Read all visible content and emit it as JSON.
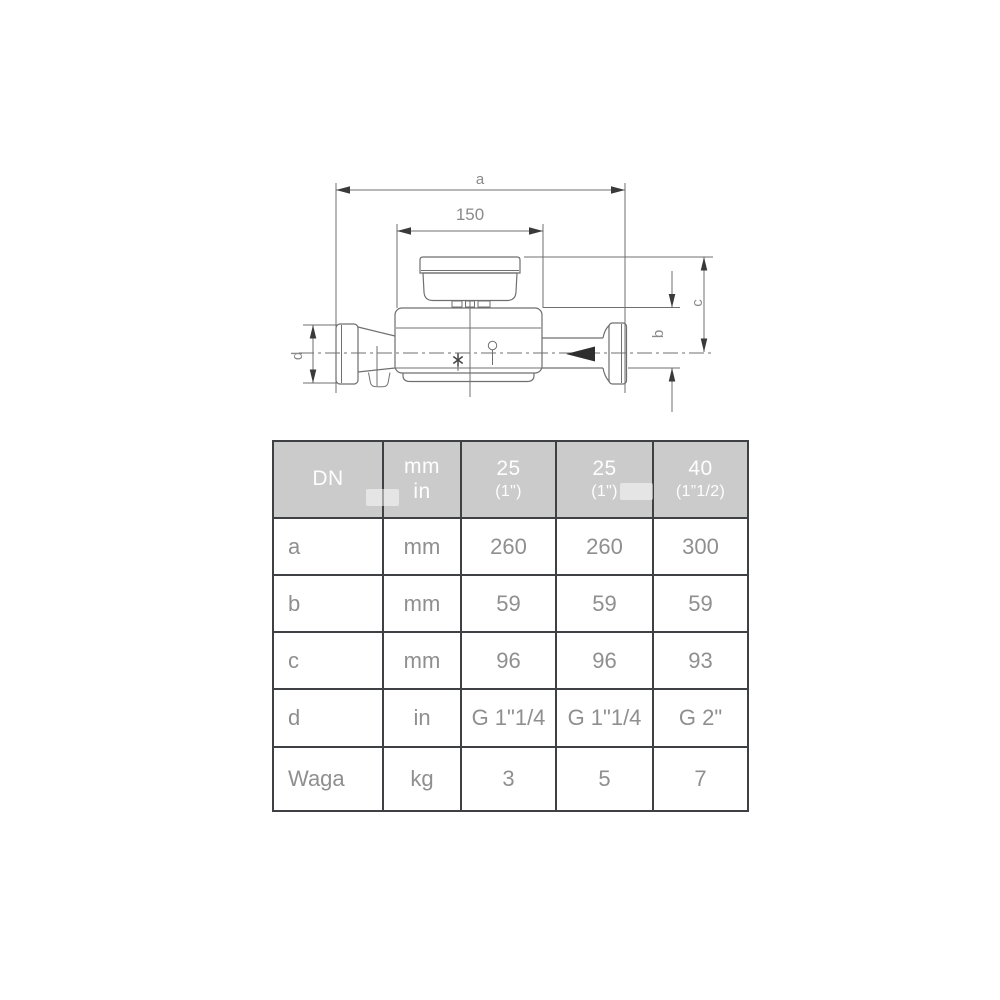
{
  "drawing": {
    "labels": {
      "a": "a",
      "length": "150",
      "b": "b",
      "c": "c",
      "d": "d"
    }
  },
  "table": {
    "header": {
      "dn": "DN",
      "unit_mm": "mm",
      "unit_in": "in",
      "columns": [
        {
          "size": "25",
          "inch": "(1\")"
        },
        {
          "size": "25",
          "inch": "(1\")"
        },
        {
          "size": "40",
          "inch": "(1”1/2)"
        }
      ]
    },
    "rows": [
      {
        "param": "a",
        "unit": "mm",
        "values": [
          "260",
          "260",
          "300"
        ]
      },
      {
        "param": "b",
        "unit": "mm",
        "values": [
          "59",
          "59",
          "59"
        ]
      },
      {
        "param": "c",
        "unit": "mm",
        "values": [
          "96",
          "96",
          "93"
        ]
      },
      {
        "param": "d",
        "unit": "in",
        "values": [
          "G 1\"1/4",
          "G 1\"1/4",
          "G 2\""
        ]
      },
      {
        "param": "Waga",
        "unit": "kg",
        "values": [
          "3",
          "5",
          "7"
        ]
      }
    ]
  },
  "colors": {
    "header_bg": "#cbcbcb",
    "header_text": "#fefefe",
    "cell_text": "#8f8f8f",
    "table_border": "#3f4043",
    "drawing_line": "#6f6f6f",
    "arrow": "#3a3a3a",
    "background": "#ffffff"
  }
}
